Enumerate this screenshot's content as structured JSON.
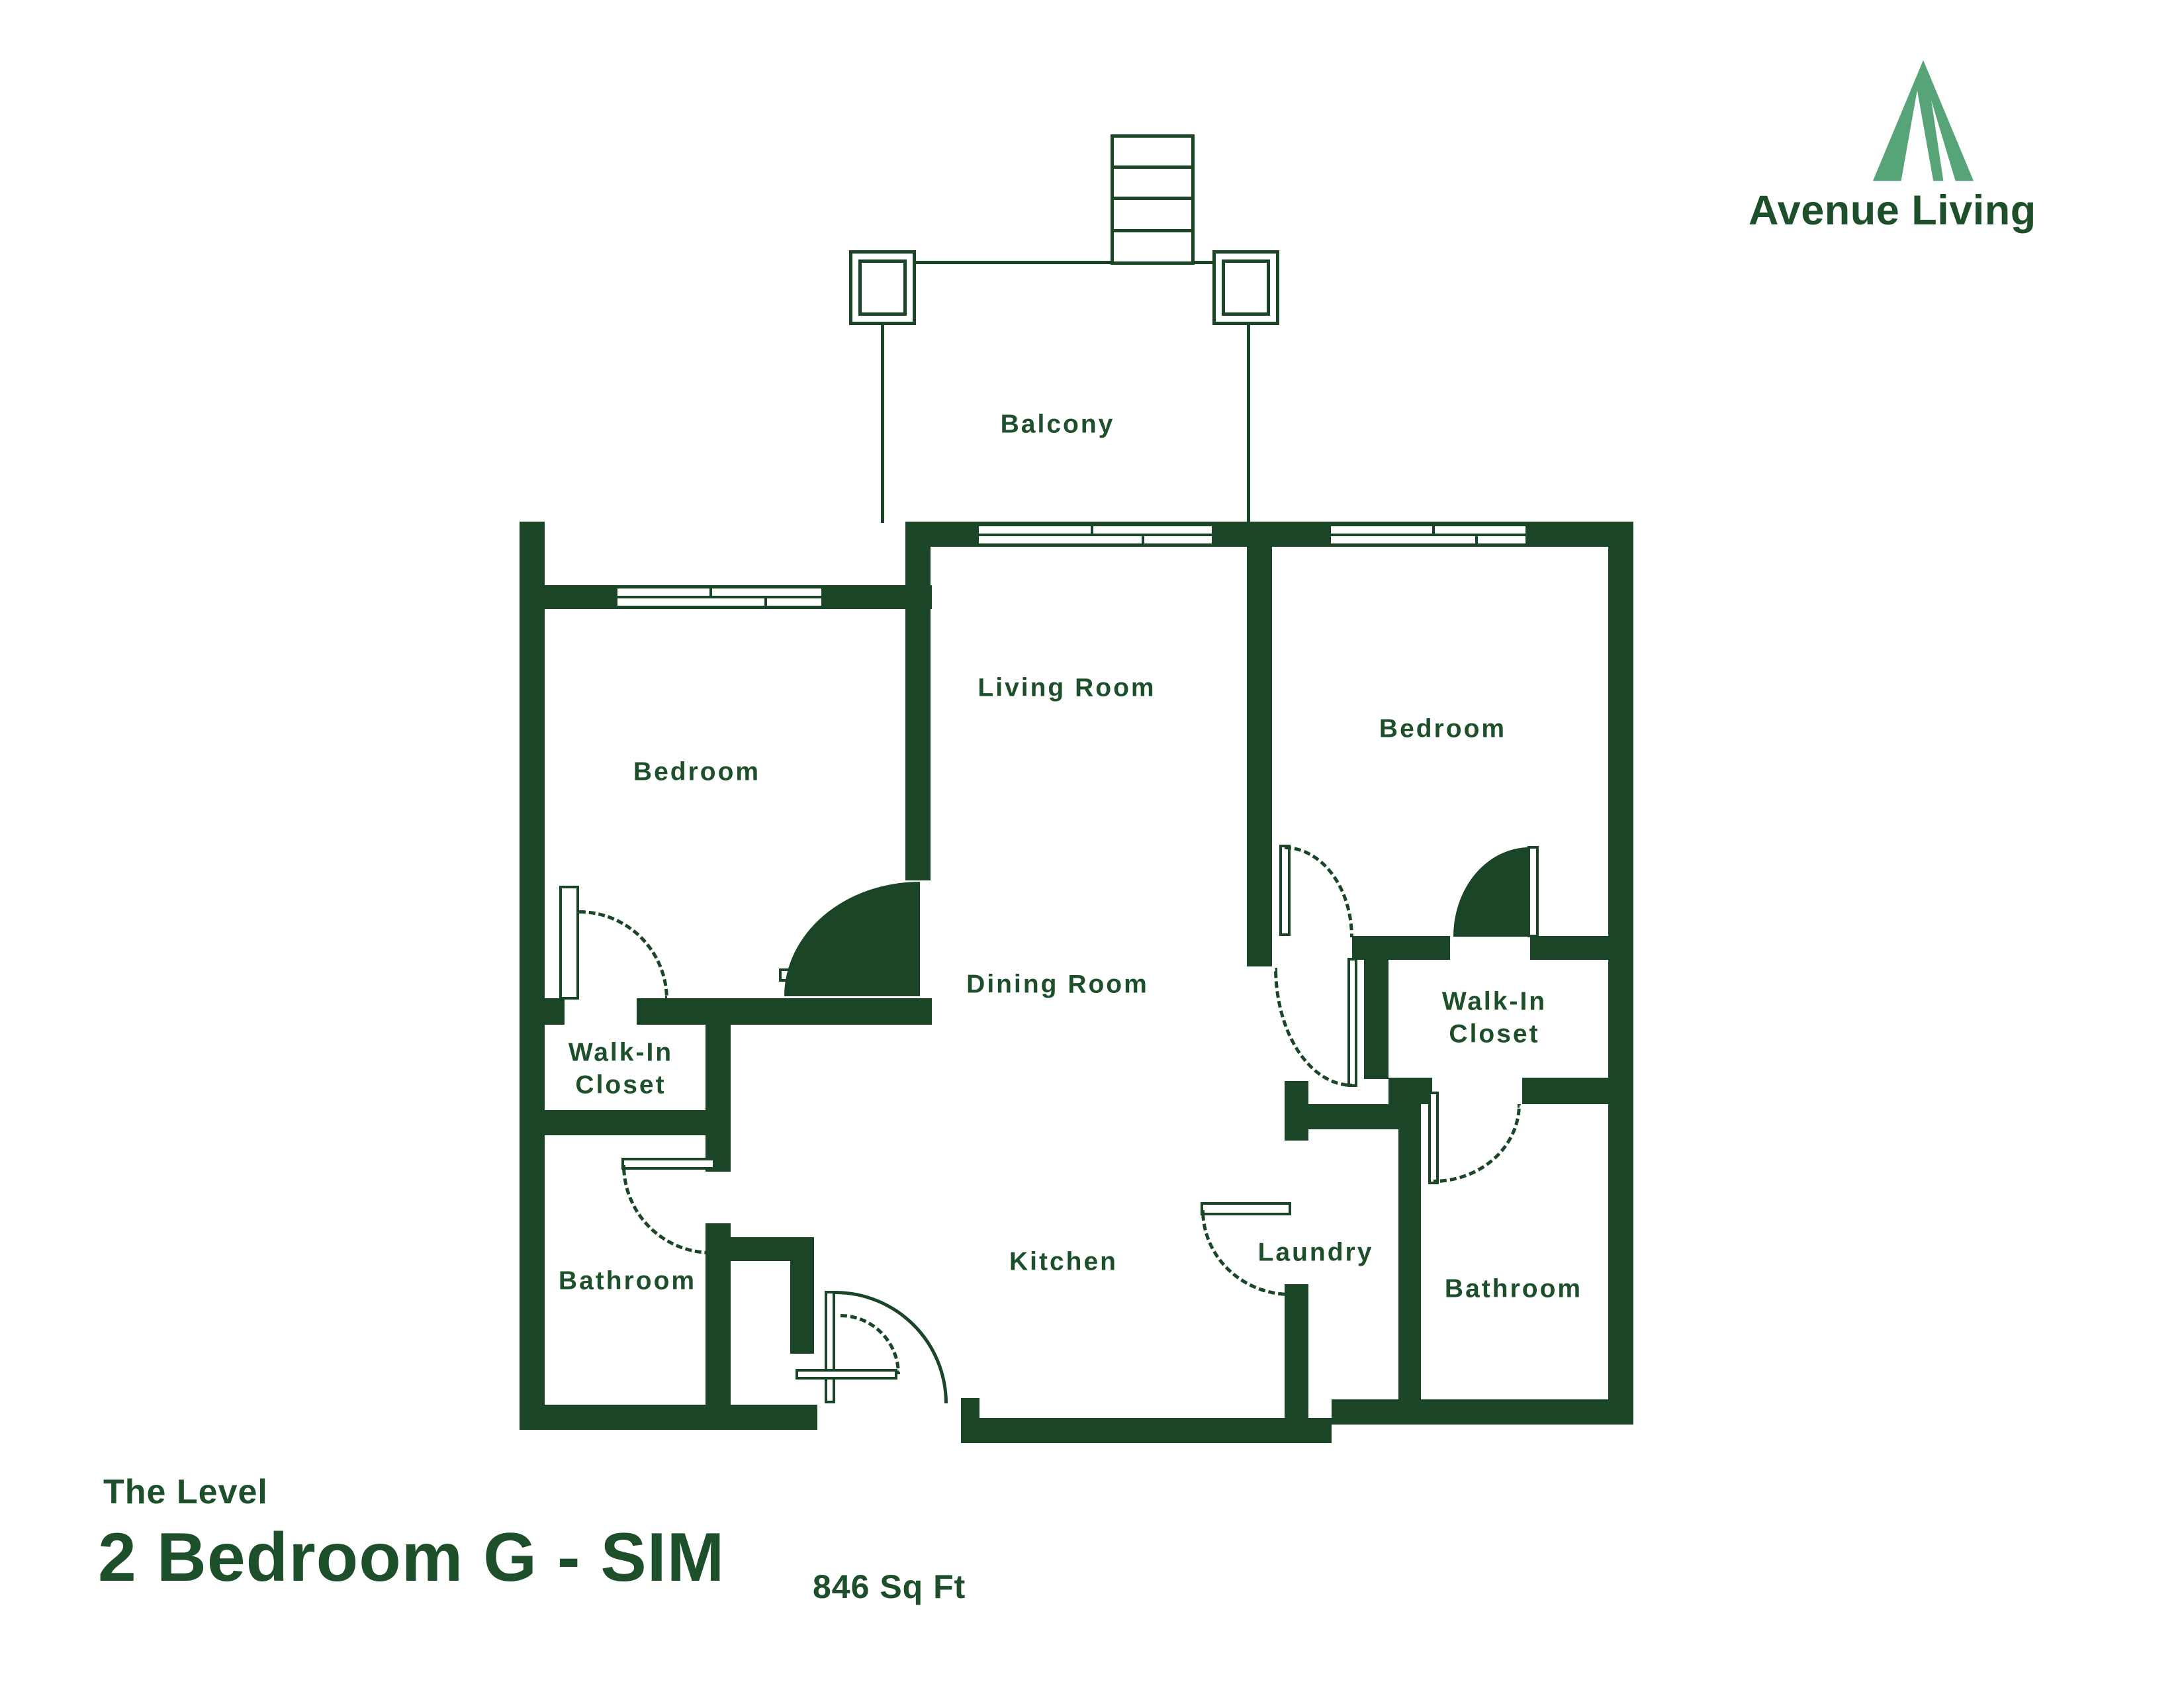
{
  "brand": {
    "logo_text": "Avenue Living"
  },
  "title": {
    "property": "The Level",
    "unit": "2 Bedroom G - SIM",
    "area": "846 Sq Ft"
  },
  "rooms": {
    "balcony": "Balcony",
    "living": "Living Room",
    "bedroom_left": "Bedroom",
    "bedroom_right": "Bedroom",
    "dining": "Dining Room",
    "walkin_left": "Walk-In\nCloset",
    "bathroom_left": "Bathroom",
    "kitchen": "Kitchen",
    "laundry": "Laundry",
    "walkin_right": "Walk-In\nCloset",
    "bathroom_right": "Bathroom"
  },
  "colors": {
    "wall": "#1a4527",
    "label": "#1d4f2b",
    "logo_mark": "#57a478"
  }
}
